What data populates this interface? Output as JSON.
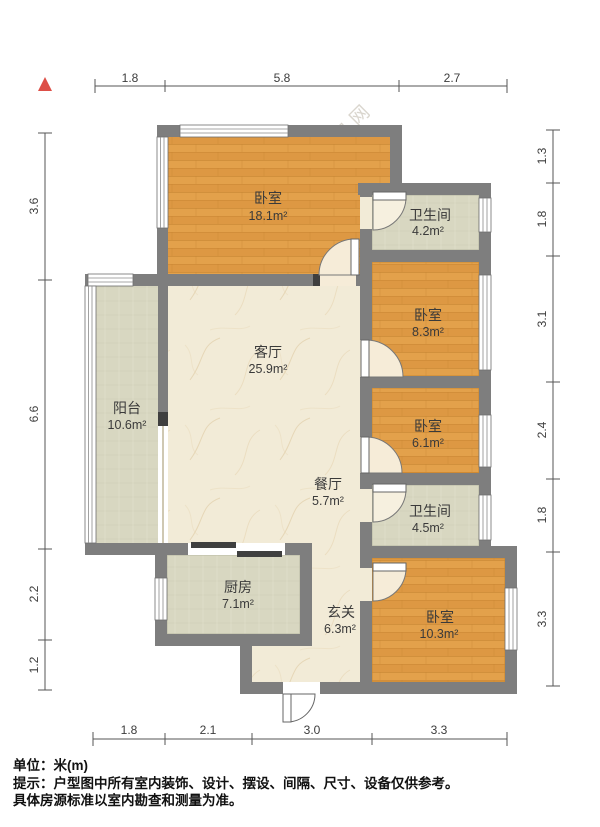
{
  "compass": {
    "symbol": "north-triangle",
    "color": "#dd4f47"
  },
  "watermark": "O房网",
  "rooms": {
    "bedroom_top": {
      "name": "卧室",
      "area": "18.1m²"
    },
    "bath_top": {
      "name": "卫生间",
      "area": "4.2m²"
    },
    "bedroom_right_upper": {
      "name": "卧室",
      "area": "8.3m²"
    },
    "living": {
      "name": "客厅",
      "area": "25.9m²"
    },
    "balcony": {
      "name": "阳台",
      "area": "10.6m²"
    },
    "bedroom_right_mid": {
      "name": "卧室",
      "area": "6.1m²"
    },
    "dining": {
      "name": "餐厅",
      "area": "5.7m²"
    },
    "bath_mid": {
      "name": "卫生间",
      "area": "4.5m²"
    },
    "kitchen": {
      "name": "厨房",
      "area": "7.1m²"
    },
    "entry": {
      "name": "玄关",
      "area": "6.3m²"
    },
    "bedroom_bottom": {
      "name": "卧室",
      "area": "10.3m²"
    }
  },
  "dimensions": {
    "top": [
      "1.8",
      "5.8",
      "2.7"
    ],
    "bottom": [
      "1.8",
      "2.1",
      "3.0",
      "3.3"
    ],
    "left": [
      "3.6",
      "6.6",
      "2.2",
      "1.2"
    ],
    "right": [
      "1.3",
      "1.8",
      "3.1",
      "2.4",
      "1.8",
      "3.3"
    ]
  },
  "footer": {
    "unit": "单位：米(m)",
    "note1": "提示：户型图中所有室内装饰、设计、摆设、间隔、尺寸、设备仅供参考。",
    "note2": "具体房源标准以室内勘查和测量为准。"
  },
  "colors": {
    "wall": "#7e7e7e",
    "bedroom_floor": "#e3a14b",
    "tile_floor": "#d8d7c1",
    "living_floor": "#f2ebd7",
    "compass_red": "#dd4f47"
  }
}
